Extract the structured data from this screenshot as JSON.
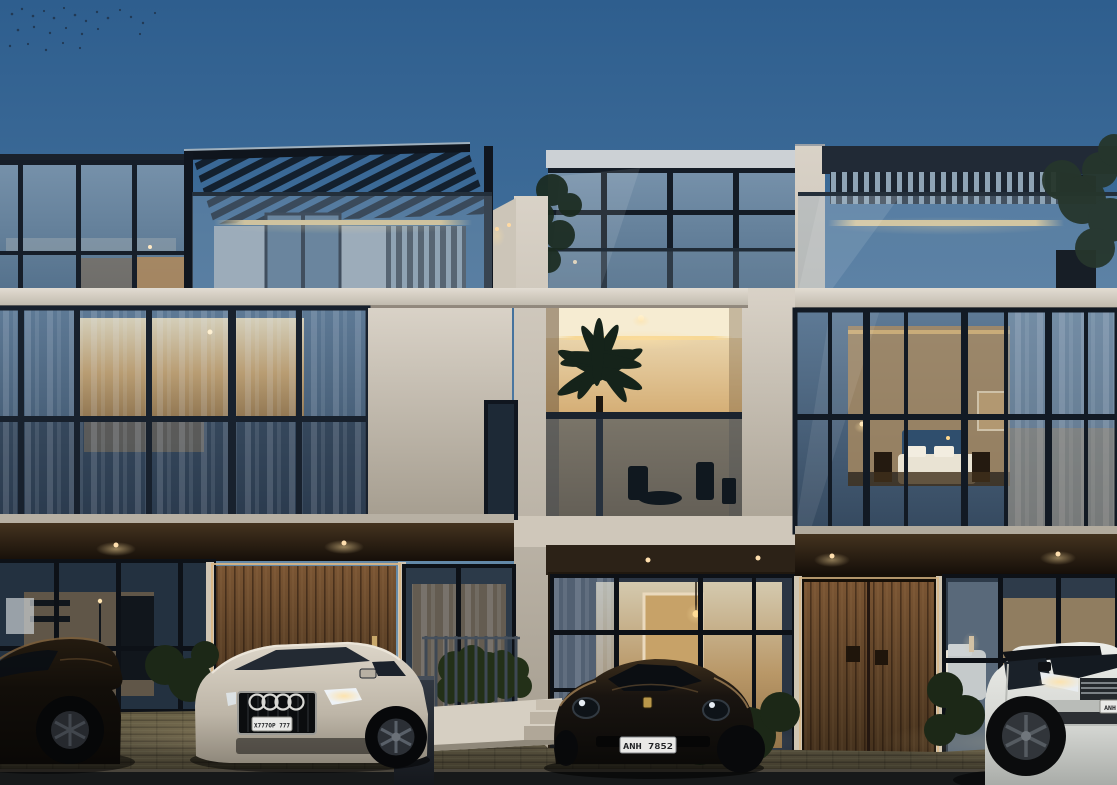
{
  "scene": {
    "type": "architectural-dusk-render",
    "subject": "Row of modern three-storey glass townhouses at dusk with warm interior lighting and luxury cars on a grass-paver driveway",
    "sky": {
      "detail": "flock of birds upper left"
    },
    "buildings": {
      "left": {
        "features": "glazed penthouse, louvered pergola roof, LED cove strip, curtained glazing, dark entry canopy, timber pivot door"
      },
      "middle": {
        "features": "recessed balcony with palm, glass balustrade, cove lighting, glazed ground floor with pendant lamp"
      },
      "right": {
        "features": "vertical louver roof screen, roof terrace with tree, double-height bedroom glazing, timber double door"
      }
    },
    "vehicles": {
      "sedan": {
        "name": "dark sedan",
        "color": "#16110b"
      },
      "audi": {
        "name": "silver Audi SUV",
        "color": "#cbc3b6",
        "plate": "X777OP 777"
      },
      "porsche": {
        "name": "dark Porsche 911",
        "color": "#171310",
        "plate": "ANH 7852"
      },
      "range_rover": {
        "name": "white Range Rover",
        "color": "#e0e1dd",
        "plate": "ANH"
      }
    }
  },
  "colors": {
    "sky-top": "#2e5e8e",
    "sky-horizon": "#8aa2b2",
    "facade-white": "#d8d2c8",
    "frame-dark": "#141c26",
    "glass-blue": "#46627f",
    "warm-light": "#f2d49c",
    "warm-deep": "#b08a55",
    "wood-door": "#5d4026",
    "canopy-dark": "#2e2318",
    "hedge-green": "#273420",
    "ground-paver": "#5a5340",
    "plate-bg": "#e9e9e7"
  }
}
